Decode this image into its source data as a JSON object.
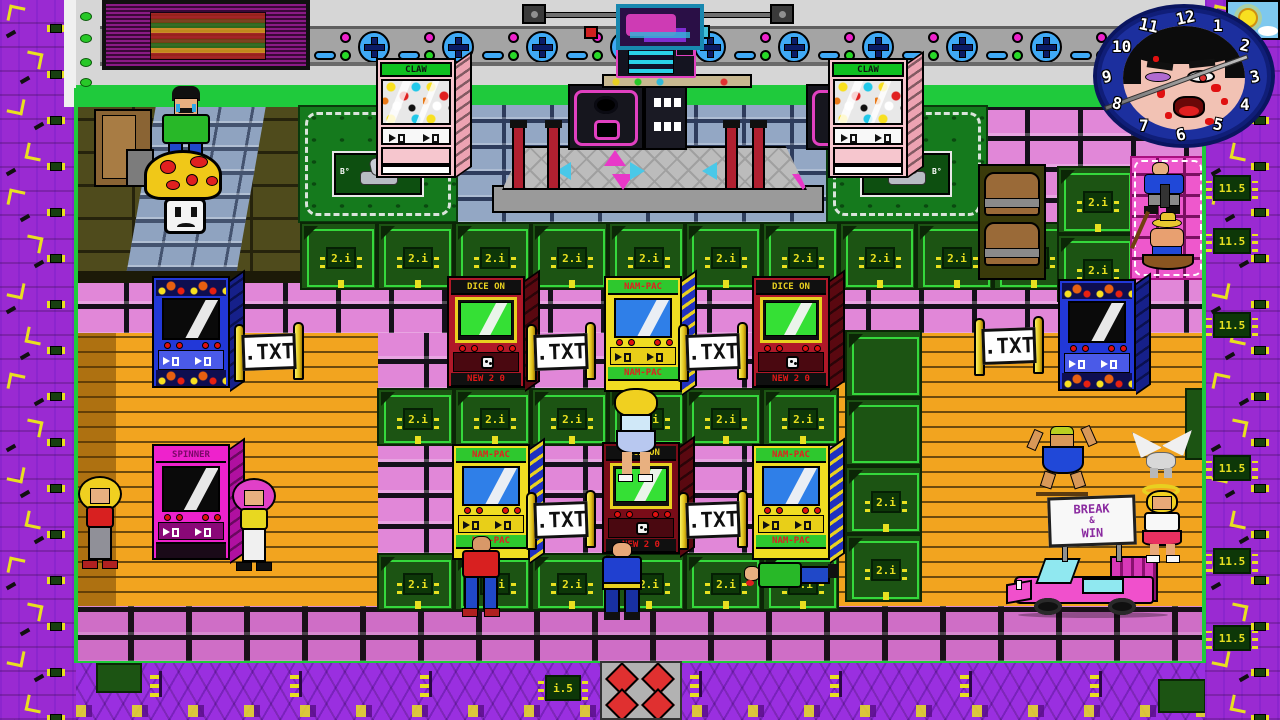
{
  "scene": {
    "description": "retro pixel-art arcade hall with machines, crates and visitors"
  },
  "top": {
    "conveyor_units": 13
  },
  "clock": {
    "numbers": [
      "12",
      "1",
      "2",
      "3",
      "4",
      "5",
      "6",
      "7",
      "8",
      "9",
      "10",
      "11"
    ]
  },
  "labels": {
    "claw": "CLAW",
    "dice_marquee": "DICE ON",
    "dice_bottom": "NEW 2 0",
    "nampac": "NAM-PAC",
    "spinner": "SPINNER",
    "txt_sign": ".TXT",
    "break_win": [
      "BREAK",
      "&",
      "WIN"
    ],
    "crate_chip": "2.i",
    "border_chip": "11.5",
    "floor_chip": "i.5",
    "grass_mark": "B°"
  },
  "cabinets": [
    {
      "type": "blue",
      "x": 152,
      "y": 276
    },
    {
      "type": "dice",
      "x": 447,
      "y": 276
    },
    {
      "type": "nampac",
      "x": 604,
      "y": 276
    },
    {
      "type": "dice",
      "x": 752,
      "y": 276
    },
    {
      "type": "blue",
      "x": 1058,
      "y": 279
    },
    {
      "type": "nampac",
      "x": 452,
      "y": 444
    },
    {
      "type": "dice2",
      "x": 602,
      "y": 442
    },
    {
      "type": "nampac",
      "x": 752,
      "y": 444
    },
    {
      "type": "spinner",
      "x": 152,
      "y": 444
    }
  ],
  "txt_signs": [
    {
      "x": 234,
      "y": 322
    },
    {
      "x": 526,
      "y": 322
    },
    {
      "x": 678,
      "y": 322
    },
    {
      "x": 526,
      "y": 490
    },
    {
      "x": 678,
      "y": 490
    },
    {
      "x": 974,
      "y": 316
    }
  ],
  "claw_machines": [
    {
      "x": 376,
      "y": 58
    },
    {
      "x": 828,
      "y": 58
    }
  ],
  "crates": {
    "row1": {
      "y": 222,
      "h": 68,
      "x": [
        300,
        377,
        454,
        531,
        608,
        685,
        762,
        839,
        916,
        993
      ],
      "chip": true
    },
    "row2": {
      "y": 388,
      "h": 58,
      "x": [
        377,
        454,
        531,
        608,
        685,
        762
      ],
      "chip": true
    },
    "row3": {
      "y": 553,
      "h": 58,
      "x": [
        377,
        454,
        531,
        608,
        685,
        762
      ],
      "chip": true
    },
    "col1": {
      "h": 68,
      "items": [
        {
          "x": 1057,
          "y": 166,
          "chip": true
        },
        {
          "x": 1057,
          "y": 234,
          "chip": true
        }
      ]
    },
    "col2": {
      "h": 68,
      "items": [
        {
          "x": 845,
          "y": 330,
          "chip": false
        },
        {
          "x": 845,
          "y": 398,
          "chip": false
        },
        {
          "x": 845,
          "y": 466,
          "chip": true
        },
        {
          "x": 845,
          "y": 534,
          "chip": true
        }
      ]
    }
  },
  "border_chips_right_y": [
    25,
    175,
    228,
    312,
    455,
    548,
    625
  ],
  "floor_glyph_x": [
    150,
    290,
    420,
    690,
    830,
    960,
    1090
  ],
  "floor_chip_x": 545
}
